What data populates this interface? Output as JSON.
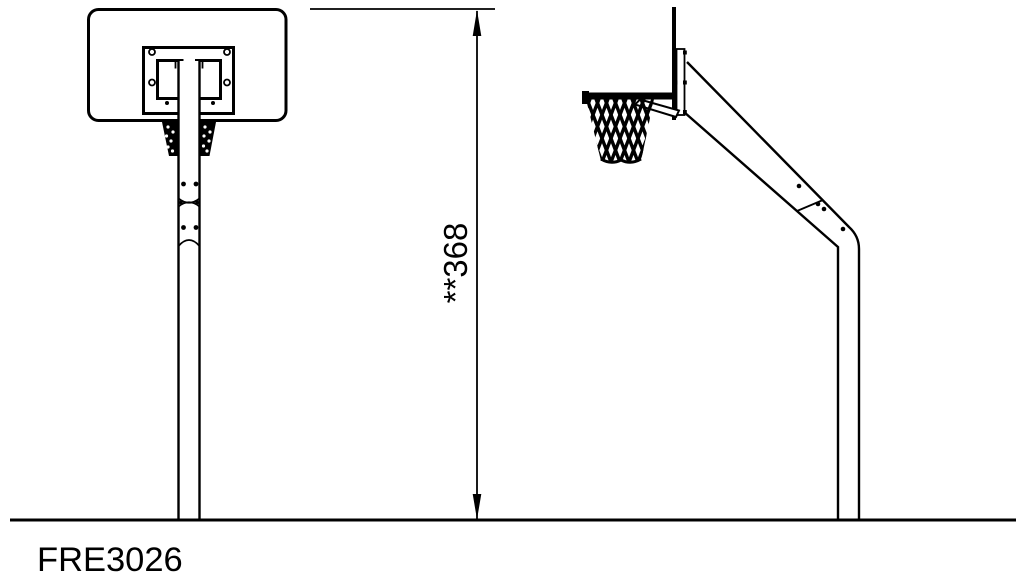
{
  "drawing": {
    "product_code": "FRE3026",
    "dimension_label": "**368",
    "dimension_value": "368",
    "dimension_prefix": "**",
    "colors": {
      "line": "#000000",
      "background": "#ffffff"
    }
  }
}
